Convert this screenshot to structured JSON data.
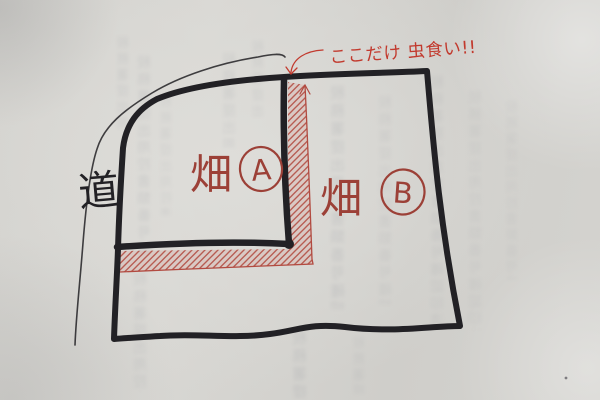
{
  "road": {
    "label": "道"
  },
  "fields": [
    {
      "kanji": "畑",
      "letter": "A"
    },
    {
      "kanji": "畑",
      "letter": "B"
    }
  ],
  "annotation": {
    "text": "ここだけ 虫食い!!"
  },
  "colors": {
    "ink_black": "#222125",
    "label_red": "#9c4037",
    "annotation_red": "#c23a2e",
    "hatch_red": "#b24a40",
    "paper_base": "#d4d3cf"
  },
  "texture": {
    "bleedthrough_chars": "税務署提出用控書類番号確認印済行数量金額合計参照図面写空欄"
  }
}
